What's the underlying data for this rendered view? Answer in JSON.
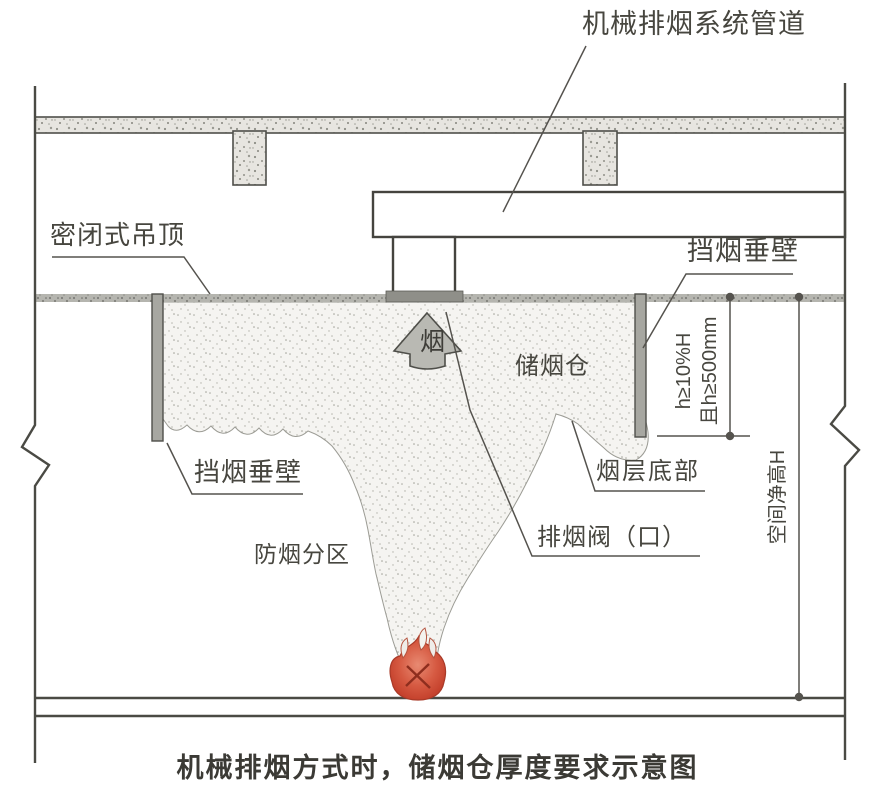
{
  "title": "机械排烟方式时，储烟仓厚度要求示意图",
  "labels": {
    "duct": "机械排烟系统管道",
    "sealed_ceiling": "密闭式吊顶",
    "smoke_barrier_right": "挡烟垂壁",
    "smoke_barrier_left": "挡烟垂壁",
    "smoke_reservoir": "储烟仓",
    "smoke_arrow": "烟",
    "smoke_layer_bottom": "烟层底部",
    "exhaust_valve": "排烟阀（口）",
    "smoke_zone": "防烟分区"
  },
  "dimensions": {
    "reservoir_depth_req_1": "h≥10%H",
    "reservoir_depth_req_2": "且h≥500mm",
    "clear_height": "空间净高H"
  },
  "colors": {
    "line": "#4a4a44",
    "text": "#47463f",
    "concrete_fill": "#e7e5e0",
    "ceiling_fill": "#b5b5af",
    "barrier_fill": "#a7a7a1",
    "smoke_fill": "#f5f4f1",
    "flame_red": "#cf4a36"
  }
}
